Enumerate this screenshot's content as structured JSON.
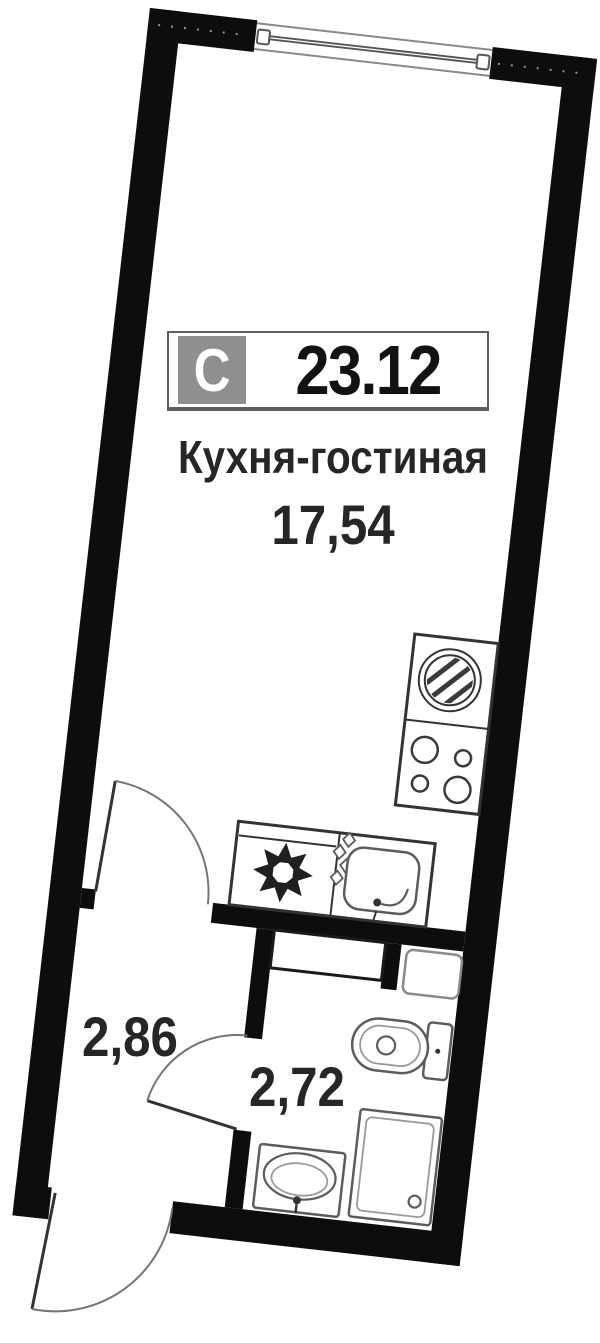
{
  "badge": {
    "section_label": "С",
    "total_area": "23.12"
  },
  "rooms": {
    "living": {
      "name": "Кухня-гостиная",
      "area": "17,54"
    },
    "hallway": {
      "area": "2,86"
    },
    "bathroom": {
      "area": "2,72"
    }
  },
  "fixtures": [
    "window",
    "entrance-door",
    "living-room-door",
    "bathroom-door",
    "kitchen-counter",
    "stove",
    "kitchen-sink",
    "washing-machine",
    "cooktop",
    "utility-shaft",
    "vent-box",
    "toilet",
    "washbasin",
    "shower-tray"
  ],
  "colors": {
    "wall": "#0d0d0d",
    "fixture": "#333333",
    "sanitary": "#5c5c5c",
    "arc": "#757575",
    "frame": "#8a8a8a",
    "badgeGray": "#8f8f8f",
    "badgeBorder": "#5e5e5e",
    "ink": "#262626"
  }
}
